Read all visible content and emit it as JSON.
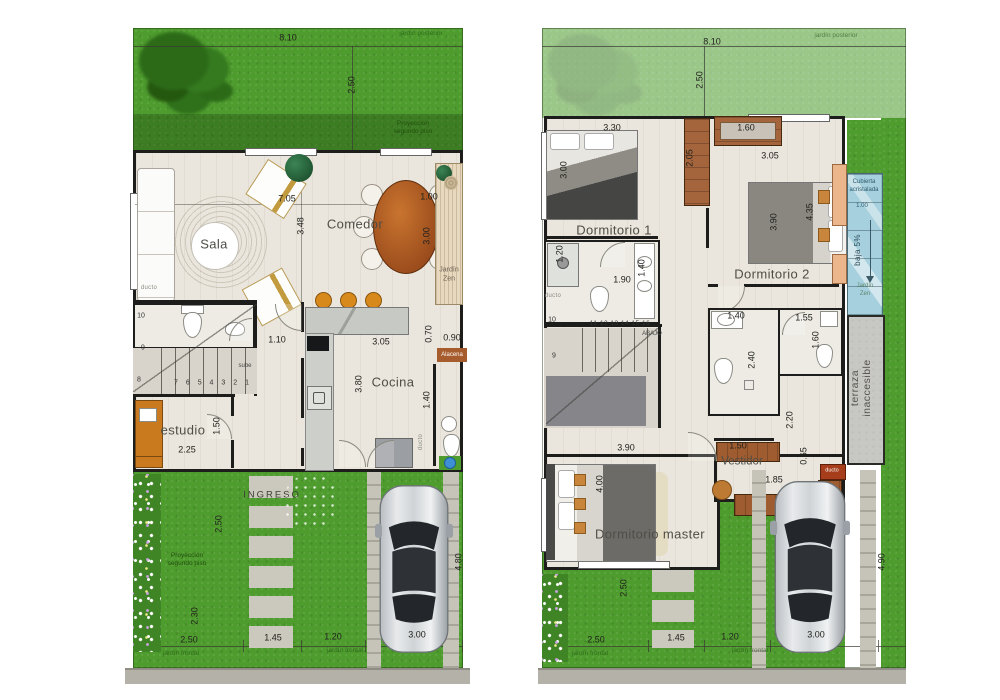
{
  "plans": {
    "ground": {
      "texts": [
        {
          "t": "8.10",
          "x": 163,
          "y": 10
        },
        {
          "t": "2.50",
          "x": 227,
          "y": 57,
          "r": 1
        },
        {
          "t": "jardín posterior",
          "x": 296,
          "y": 6,
          "cls": "faint"
        },
        {
          "t": "Proyección",
          "x": 288,
          "y": 96,
          "cls": "proj"
        },
        {
          "t": "segundo piso",
          "x": 288,
          "y": 104,
          "cls": "proj"
        },
        {
          "t": "7.05",
          "x": 162,
          "y": 171
        },
        {
          "t": "3.48",
          "x": 176,
          "y": 198,
          "r": 1
        },
        {
          "t": "1.00",
          "x": 304,
          "y": 169
        },
        {
          "t": "3.00",
          "x": 302,
          "y": 208,
          "r": 1
        },
        {
          "t": "Jardín",
          "x": 324,
          "y": 242,
          "cls": "tiny"
        },
        {
          "t": "Zen",
          "x": 324,
          "y": 251,
          "cls": "tiny"
        },
        {
          "t": "Sala",
          "x": 89,
          "y": 216,
          "cls": "room",
          "n": "room-label-sala"
        },
        {
          "t": "Comedor",
          "x": 230,
          "y": 196,
          "cls": "room",
          "n": "room-label-comedor"
        },
        {
          "t": "ducto",
          "x": 24,
          "y": 260,
          "cls": "ducto"
        },
        {
          "t": "10",
          "x": 16,
          "y": 288,
          "cls": "num"
        },
        {
          "t": "9",
          "x": 18,
          "y": 320,
          "cls": "num"
        },
        {
          "t": "8",
          "x": 14,
          "y": 352,
          "cls": "num"
        },
        {
          "t": "7 6 5 4 3 2 1",
          "x": 88,
          "y": 355,
          "cls": "seq"
        },
        {
          "t": "sube",
          "x": 120,
          "y": 338,
          "cls": "abajo"
        },
        {
          "t": "1.10",
          "x": 152,
          "y": 312
        },
        {
          "t": "3.05",
          "x": 256,
          "y": 314
        },
        {
          "t": "3.80",
          "x": 234,
          "y": 356,
          "r": 1
        },
        {
          "t": "Cocina",
          "x": 268,
          "y": 354,
          "cls": "room",
          "n": "room-label-cocina"
        },
        {
          "t": "0.70",
          "x": 304,
          "y": 306,
          "r": 1
        },
        {
          "t": "0.90",
          "x": 327,
          "y": 310
        },
        {
          "t": "Alacena",
          "x": 327,
          "y": 327,
          "cls": "alacena",
          "n": "label-alacena"
        },
        {
          "t": "1.40",
          "x": 302,
          "y": 372,
          "r": 1
        },
        {
          "t": "ducto",
          "x": 296,
          "y": 414,
          "cls": "ducto",
          "r": 1
        },
        {
          "t": "estudio",
          "x": 58,
          "y": 402,
          "cls": "room",
          "n": "room-label-estudio"
        },
        {
          "t": "2.25",
          "x": 62,
          "y": 422
        },
        {
          "t": "1.50",
          "x": 92,
          "y": 398,
          "r": 1
        },
        {
          "t": "INGRESO",
          "x": 147,
          "y": 467,
          "cls": "ingreso",
          "n": "label-ingreso"
        },
        {
          "t": "2.50",
          "x": 94,
          "y": 496,
          "r": 1
        },
        {
          "t": "Proyección",
          "x": 62,
          "y": 528,
          "cls": "proj"
        },
        {
          "t": "segundo piso",
          "x": 62,
          "y": 536,
          "cls": "proj"
        },
        {
          "t": "2.30",
          "x": 70,
          "y": 588,
          "r": 1
        },
        {
          "t": "4.80",
          "x": 334,
          "y": 534,
          "r": 1
        },
        {
          "t": "2.50",
          "x": 64,
          "y": 612
        },
        {
          "t": "1.45",
          "x": 148,
          "y": 610
        },
        {
          "t": "1.20",
          "x": 208,
          "y": 609
        },
        {
          "t": "3.00",
          "x": 292,
          "y": 607
        },
        {
          "t": "jardín frontal",
          "x": 56,
          "y": 626,
          "cls": "faint"
        },
        {
          "t": "jardín frontal",
          "x": 220,
          "y": 623,
          "cls": "faint"
        }
      ]
    },
    "upper": {
      "texts": [
        {
          "t": "8.10",
          "x": 174,
          "y": 14
        },
        {
          "t": "2.50",
          "x": 162,
          "y": 52,
          "r": 1
        },
        {
          "t": "jardín posterior",
          "x": 298,
          "y": 8,
          "cls": "faint"
        },
        {
          "t": "3.30",
          "x": 74,
          "y": 100
        },
        {
          "t": "3.00",
          "x": 26,
          "y": 142,
          "r": 1
        },
        {
          "t": "2.05",
          "x": 152,
          "y": 130,
          "r": 1
        },
        {
          "t": "1.60",
          "x": 208,
          "y": 100
        },
        {
          "t": "3.05",
          "x": 232,
          "y": 128
        },
        {
          "t": "Dormitorio 1",
          "x": 76,
          "y": 202,
          "cls": "room",
          "n": "room-label-dormitorio-1"
        },
        {
          "t": "Dormitorio 2",
          "x": 234,
          "y": 246,
          "cls": "room",
          "n": "room-label-dormitorio-2"
        },
        {
          "t": "3.90",
          "x": 236,
          "y": 194,
          "r": 1
        },
        {
          "t": "4.35",
          "x": 272,
          "y": 184,
          "r": 1
        },
        {
          "t": "Cubierta",
          "x": 326,
          "y": 154,
          "cls": "glass"
        },
        {
          "t": "acristalada",
          "x": 326,
          "y": 162,
          "cls": "glass"
        },
        {
          "t": "1.00",
          "x": 324,
          "y": 178,
          "cls": "glass"
        },
        {
          "t": "baja 5%",
          "x": 320,
          "y": 222,
          "r": 1,
          "cls": "baja"
        },
        {
          "t": "Jardín",
          "x": 327,
          "y": 258,
          "cls": "glassf"
        },
        {
          "t": "Zen",
          "x": 327,
          "y": 266,
          "cls": "glassf"
        },
        {
          "t": "1.20",
          "x": 22,
          "y": 226,
          "r": 1
        },
        {
          "t": "1.90",
          "x": 84,
          "y": 252
        },
        {
          "t": "1.40",
          "x": 104,
          "y": 240,
          "r": 1
        },
        {
          "t": "ducto",
          "x": 15,
          "y": 268,
          "cls": "ducto"
        },
        {
          "t": "10",
          "x": 14,
          "y": 292,
          "cls": "num"
        },
        {
          "t": "9",
          "x": 16,
          "y": 328,
          "cls": "num"
        },
        {
          "t": "11 12 13 14 15 16",
          "x": 82,
          "y": 296,
          "cls": "seq2"
        },
        {
          "t": "ABAJO",
          "x": 114,
          "y": 306,
          "cls": "abajo"
        },
        {
          "t": "1.40",
          "x": 198,
          "y": 288
        },
        {
          "t": "2.40",
          "x": 214,
          "y": 332,
          "r": 1
        },
        {
          "t": "1.55",
          "x": 266,
          "y": 290
        },
        {
          "t": "1.60",
          "x": 278,
          "y": 312,
          "r": 1
        },
        {
          "t": "terraza",
          "x": 317,
          "y": 360,
          "r": 1,
          "cls": "terra"
        },
        {
          "t": "inaccesible",
          "x": 329,
          "y": 360,
          "r": 1,
          "cls": "terra"
        },
        {
          "t": "3.90",
          "x": 88,
          "y": 420
        },
        {
          "t": "4.00",
          "x": 62,
          "y": 456,
          "r": 1
        },
        {
          "t": "Dormitorio master",
          "x": 112,
          "y": 506,
          "cls": "room",
          "n": "room-label-dormitorio-master"
        },
        {
          "t": "Vestidor",
          "x": 204,
          "y": 434,
          "cls": "room2",
          "n": "room-label-vestidor"
        },
        {
          "t": "1.50",
          "x": 200,
          "y": 418
        },
        {
          "t": "2.20",
          "x": 252,
          "y": 392,
          "r": 1
        },
        {
          "t": "0.65",
          "x": 266,
          "y": 428,
          "r": 1
        },
        {
          "t": "1.85",
          "x": 236,
          "y": 452
        },
        {
          "t": "ducto",
          "x": 294,
          "y": 443,
          "cls": "ducto2"
        },
        {
          "t": "2.50",
          "x": 86,
          "y": 560,
          "r": 1
        },
        {
          "t": "4.90",
          "x": 344,
          "y": 534,
          "r": 1
        },
        {
          "t": "2.50",
          "x": 58,
          "y": 612
        },
        {
          "t": "1.45",
          "x": 138,
          "y": 610
        },
        {
          "t": "1.20",
          "x": 192,
          "y": 609
        },
        {
          "t": "3.00",
          "x": 278,
          "y": 607
        },
        {
          "t": "jardín frontal",
          "x": 52,
          "y": 626,
          "cls": "faint"
        },
        {
          "t": "jardín frontal",
          "x": 212,
          "y": 623,
          "cls": "faint"
        }
      ]
    }
  },
  "colors": {
    "grass": "#4e9c2e",
    "floor": "#eae6dd",
    "wall": "#1d1d1b",
    "glass_roof": "#a8cfd9",
    "closet": "#a5653c",
    "accent_orange": "#d8891b"
  }
}
